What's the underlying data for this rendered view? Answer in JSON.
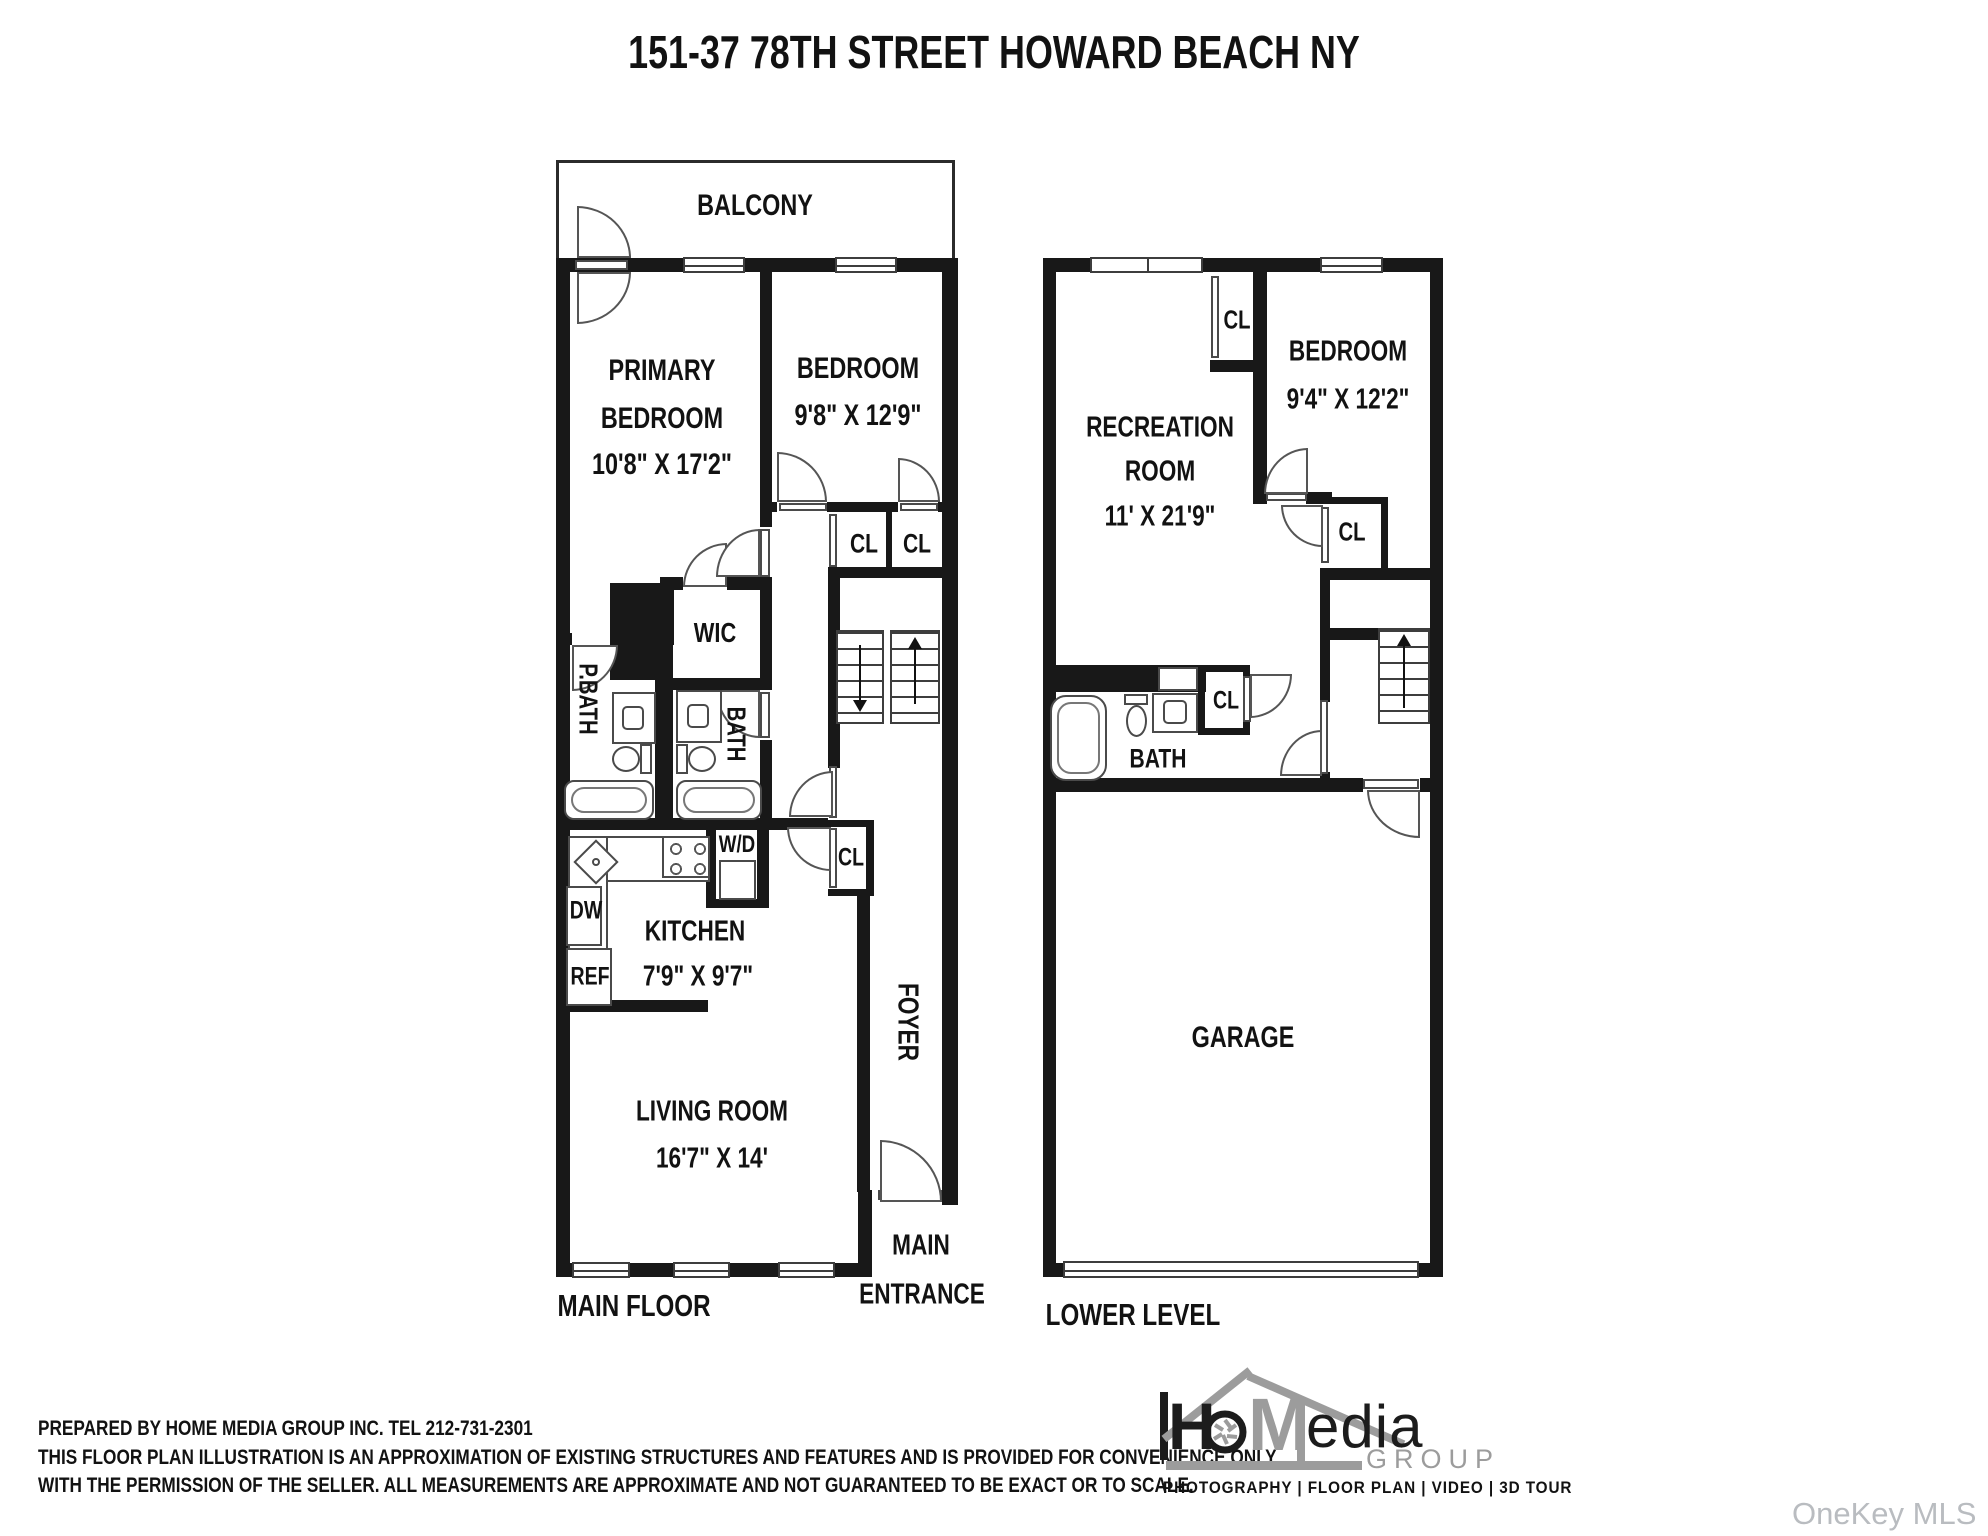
{
  "title": "151-37 78TH STREET HOWARD BEACH NY",
  "main_floor": {
    "floor_label": "MAIN FLOOR",
    "balcony": "BALCONY",
    "primary_bedroom": {
      "name1": "PRIMARY",
      "name2": "BEDROOM",
      "dims": "10'8\" X 17'2\""
    },
    "bedroom": {
      "name": "BEDROOM",
      "dims": "9'8\" X 12'9\""
    },
    "closet_left": "CL",
    "closet_right": "CL",
    "closet_hall": "CL",
    "wic": "WIC",
    "primary_bath": "P.BATH",
    "bath": "BATH",
    "washer_dryer": "W/D",
    "dishwasher": "DW",
    "refrigerator": "REF",
    "kitchen": {
      "name": "KITCHEN",
      "dims": "7'9\" X 9'7\""
    },
    "foyer": "FOYER",
    "living_room": {
      "name": "LIVING ROOM",
      "dims": "16'7\" X 14'"
    },
    "entrance_line1": "MAIN",
    "entrance_line2": "ENTRANCE"
  },
  "lower_level": {
    "floor_label": "LOWER LEVEL",
    "recreation_room": {
      "name1": "RECREATION",
      "name2": "ROOM",
      "dims": "11' X 21'9\""
    },
    "bedroom": {
      "name": "BEDROOM",
      "dims": "9'4\" X 12'2\""
    },
    "closet_top": "CL",
    "closet_mid": "CL",
    "closet_bath": "CL",
    "bath": "BATH",
    "garage": "GARAGE"
  },
  "footer": {
    "prepared_by": "PREPARED BY  HOME MEDIA GROUP INC.  TEL 212-731-2301",
    "disclaimer1": "THIS FLOOR PLAN ILLUSTRATION IS AN APPROXIMATION OF EXISTING STRUCTURES AND FEATURES AND IS PROVIDED FOR CONVENIENCE ONLY",
    "disclaimer2": "WITH THE PERMISSION OF THE SELLER. ALL MEASUREMENTS ARE APPROXIMATE AND NOT GUARANTEED TO BE EXACT OR TO SCALE."
  },
  "logo": {
    "letter_h": "H",
    "letter_m": "M",
    "letters_edia": "edia",
    "group": "GROUP",
    "tagline": "PHOTOGRAPHY | FLOOR PLAN | VIDEO | 3D TOUR"
  },
  "watermark": "OneKey MLS",
  "colors": {
    "ink": "#181818",
    "logo_gray": "#9c9c9c",
    "watermark_gray": "#b9bcc0"
  }
}
